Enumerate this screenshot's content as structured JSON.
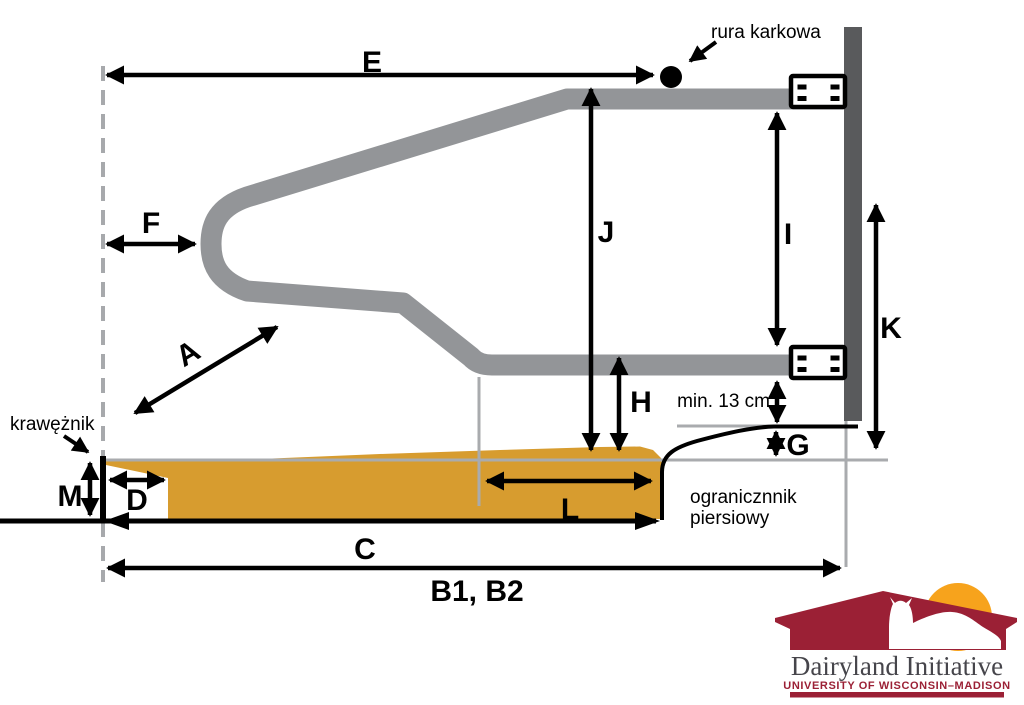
{
  "diagram": {
    "dimension_labels": {
      "A": "A",
      "B": "B1, B2",
      "C": "C",
      "D": "D",
      "E": "E",
      "F": "F",
      "G": "G",
      "H": "H",
      "I": "I",
      "J": "J",
      "K": "K",
      "L": "L",
      "M": "M"
    },
    "annotations": {
      "neck_rail": "rura karkowa",
      "curb": "krawężnik",
      "brisket_board_line1": "ogranicznnik",
      "brisket_board_line2": "piersiowy",
      "min_clearance": "min. 13 cm"
    }
  },
  "logo": {
    "title": "Dairyland Initiative",
    "subtitle": "UNIVERSITY OF WISCONSIN–MADISON"
  },
  "colors": {
    "bedding_gold": "#d79c2f",
    "rail_gray": "#939598",
    "post_dark_gray": "#595a5c",
    "reference_gray": "#a9abae",
    "dashed_gray": "#a7a9ac",
    "logo_red": "#9b2035",
    "logo_sun_orange": "#f7a31c",
    "logo_text_gray": "#46454b",
    "line_black": "#000000"
  }
}
